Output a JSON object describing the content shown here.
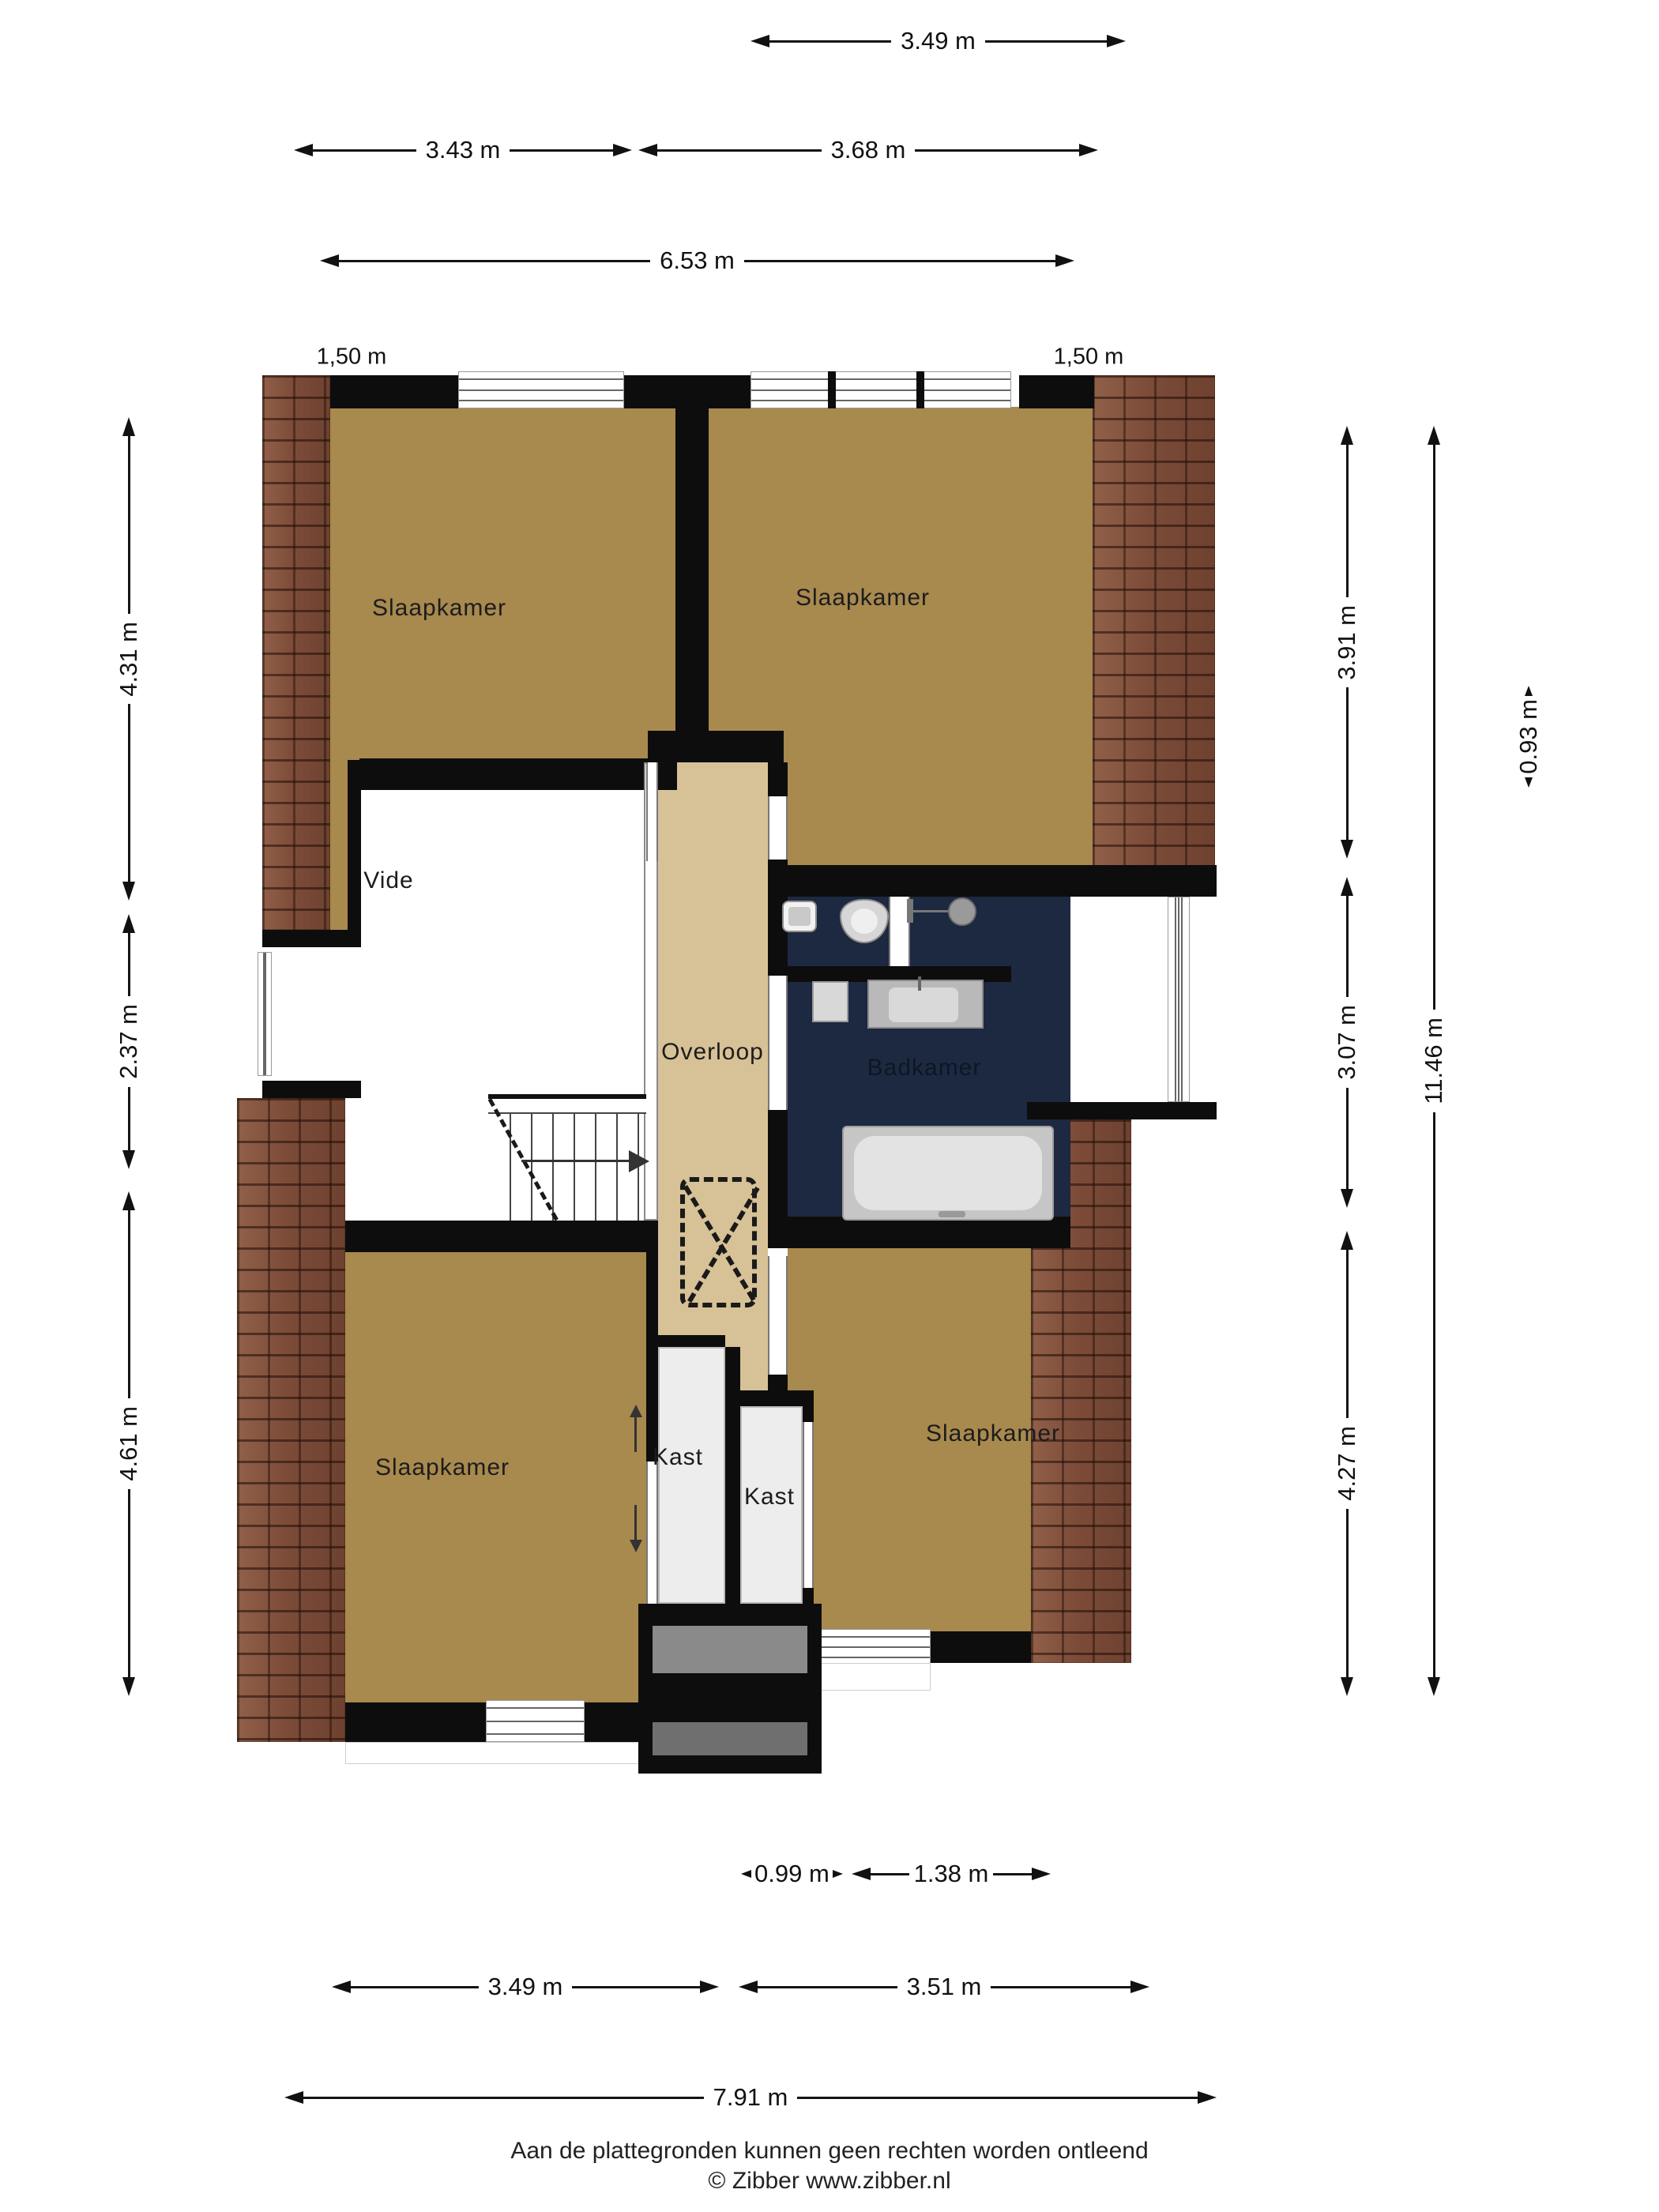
{
  "rooms": {
    "slaapkamer_tl": "Slaapkamer",
    "slaapkamer_tr": "Slaapkamer",
    "slaapkamer_bl": "Slaapkamer",
    "slaapkamer_br": "Slaapkamer",
    "vide": "Vide",
    "overloop": "Overloop",
    "badkamer": "Badkamer",
    "kast_left": "Kast",
    "kast_right": "Kast"
  },
  "dimensions": {
    "top_wing": "3.49 m",
    "top_left_room": "3.43 m",
    "top_right_room": "3.68 m",
    "top_total": "6.53 m",
    "headroom_left": "1,50 m",
    "headroom_right": "1,50 m",
    "left_top": "4.31 m",
    "left_mid": "2.37 m",
    "left_bottom": "4.61 m",
    "right_top": "3.91 m",
    "right_mid": "3.07 m",
    "right_bottom": "4.27 m",
    "right_total": "11.46 m",
    "dormer_depth": "0.93 m",
    "bottom_closet_left": "0.99 m",
    "bottom_closet_right": "1.38 m",
    "bottom_left": "3.49 m",
    "bottom_right": "3.51 m",
    "bottom_total": "7.91 m"
  },
  "footer": {
    "disclaimer": "Aan de plattegronden kunnen geen rechten worden ontleend",
    "copyright": "© Zibber www.zibber.nl"
  },
  "colors": {
    "bedroom_floor": "#a8894e",
    "hall_floor": "#d7c196",
    "bathroom_floor": "#1d2940",
    "closet_floor": "#ededed",
    "wall": "#0d0d0d",
    "roof_tiles": "#7d4e3b"
  }
}
